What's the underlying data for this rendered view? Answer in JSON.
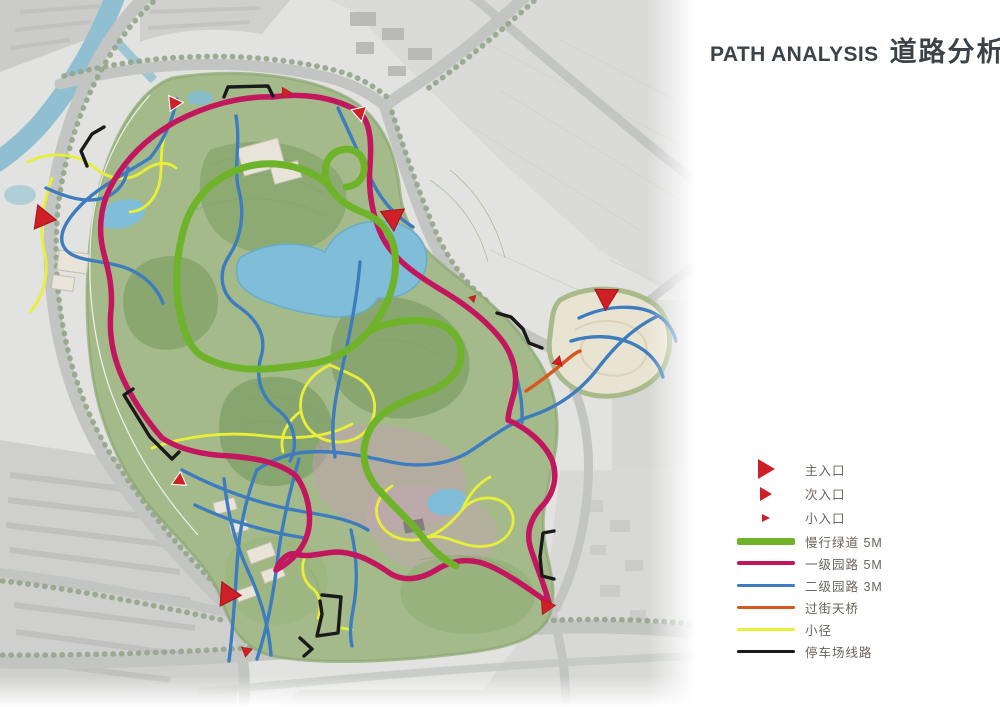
{
  "title": {
    "en": "PATH ANALYSIS",
    "zh": "道路分析"
  },
  "legend": {
    "entrances": [
      {
        "label": "主入口",
        "size": "large"
      },
      {
        "label": "次入口",
        "size": "medium"
      },
      {
        "label": "小入口",
        "size": "small"
      }
    ],
    "paths": [
      {
        "label": "慢行绿道 5M",
        "key": "greenway",
        "color": "#6fb32a",
        "weight": 7
      },
      {
        "label": "一级园路 5M",
        "key": "primary",
        "color": "#c2175f",
        "weight": 4
      },
      {
        "label": "二级园路 3M",
        "key": "secondary",
        "color": "#3d7cbe",
        "weight": 3
      },
      {
        "label": "过街天桥",
        "key": "bridge",
        "color": "#d8571f",
        "weight": 3
      },
      {
        "label": "小径",
        "key": "trail",
        "color": "#e9ef38",
        "weight": 3
      },
      {
        "label": "停车场线路",
        "key": "parking",
        "color": "#1a1a1a",
        "weight": 3
      }
    ]
  },
  "map": {
    "colors": {
      "entrance": "#ce2026",
      "greenway": "#6fb32a",
      "primary": "#c2175f",
      "secondary": "#3d7cbe",
      "bridge": "#d8571f",
      "trail": "#e9ef38",
      "parking": "#1a1a1a",
      "road": "#c3c5c3",
      "water": "#7fbdd9",
      "river": "#8fbfd0",
      "park": "#a5ba8b",
      "urban": "#e2e3e1"
    }
  }
}
